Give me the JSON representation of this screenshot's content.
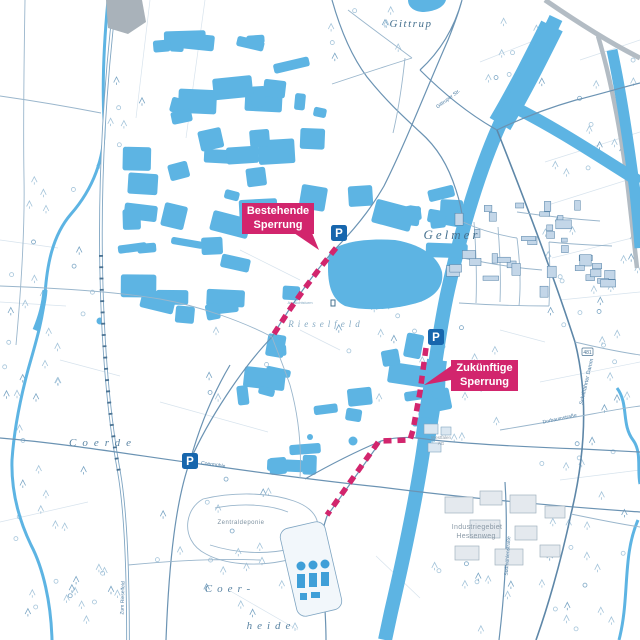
{
  "colors": {
    "accent_magenta": "#d2256d",
    "water_blue": "#5db4e3",
    "tank_blue": "#3f9fd8",
    "parking_blue": "#1766ad",
    "street_blue": "#6b93b3",
    "street_dark": "#5e87a8",
    "street_light": "#9ab6cc",
    "label_blue": "#46718f",
    "gray_road": "#b3bcc4"
  },
  "place_labels": [
    {
      "id": "gittrup",
      "text": "Gittrup",
      "x": 411,
      "y": 27,
      "size": 11,
      "spacing": 1.5,
      "italic": true,
      "color": "#46718f"
    },
    {
      "id": "gelmer",
      "text": "Gelmer",
      "x": 452,
      "y": 239,
      "size": 13,
      "spacing": 3,
      "italic": true,
      "color": "#46718f"
    },
    {
      "id": "coerde",
      "text": "Coerde",
      "x": 103,
      "y": 446,
      "size": 11,
      "spacing": 6,
      "italic": true,
      "color": "#5a84a3"
    },
    {
      "id": "rieselfeld",
      "text": "Rieselfeld",
      "x": 326,
      "y": 327,
      "size": 9,
      "spacing": 4,
      "italic": true,
      "color": "#84a9c2"
    },
    {
      "id": "zentraldeponie",
      "text": "Zentraldeponie",
      "x": 241,
      "y": 524,
      "size": 6,
      "spacing": 0.5,
      "italic": false,
      "color": "#7d91a0"
    },
    {
      "id": "coer",
      "text": "Coer-",
      "x": 230,
      "y": 592,
      "size": 11,
      "spacing": 5,
      "italic": true,
      "color": "#5a84a3"
    },
    {
      "id": "heide",
      "text": "heide",
      "x": 271,
      "y": 629,
      "size": 11,
      "spacing": 5,
      "italic": true,
      "color": "#5a84a3"
    },
    {
      "id": "industriegebiet",
      "text": "Industriegebiet",
      "x": 477,
      "y": 529,
      "size": 7,
      "spacing": 0.3,
      "italic": false,
      "color": "#8b9aa7"
    },
    {
      "id": "hessenweg-area",
      "text": "Hessenweg",
      "x": 476,
      "y": 538,
      "size": 7,
      "spacing": 0.3,
      "italic": false,
      "color": "#8b9aa7"
    },
    {
      "id": "westfalen-ag-1",
      "text": "Westfalen",
      "x": 441,
      "y": 439,
      "size": 4.5,
      "spacing": 0,
      "italic": false,
      "color": "#8b9aa7"
    },
    {
      "id": "westfalen-ag-2",
      "text": "AG",
      "x": 441,
      "y": 445,
      "size": 4.5,
      "spacing": 0,
      "italic": false,
      "color": "#8b9aa7"
    },
    {
      "id": "aussichtsturm",
      "text": "Aussichtsturm",
      "x": 300,
      "y": 304,
      "size": 4,
      "spacing": 0,
      "italic": false,
      "color": "#84a9c2"
    }
  ],
  "street_labels": [
    {
      "id": "schifffahrter-damm",
      "text": "Schifffahrter Damm",
      "x": 588,
      "y": 382,
      "size": 5.5,
      "rot": -77,
      "color": "#4d7da3"
    },
    {
      "id": "gittruper-str",
      "text": "Gittruper Str.",
      "x": 449,
      "y": 100,
      "size": 5,
      "rot": -37,
      "color": "#4d7da3"
    },
    {
      "id": "dorbaumstrasse",
      "text": "Dorbaumstraße",
      "x": 560,
      "y": 420,
      "size": 5,
      "rot": -12,
      "color": "#4d7da3"
    },
    {
      "id": "sudmuehlenstrasse",
      "text": "Sudmühlenstraße",
      "x": 509,
      "y": 556,
      "size": 5,
      "rot": -86,
      "color": "#4d7da3"
    },
    {
      "id": "zum-rieselfeld",
      "text": "Zum Rieselfeld",
      "x": 124,
      "y": 598,
      "size": 5,
      "rot": -88,
      "color": "#4d7da3"
    },
    {
      "id": "coermuehle",
      "text": "Coermühle",
      "x": 213,
      "y": 466,
      "size": 5,
      "rot": 8,
      "color": "#4d7da3"
    }
  ],
  "road_badge": {
    "text": "481",
    "x": 582,
    "y": 348
  },
  "annotations": {
    "existing_closure": {
      "line1": "Bestehende",
      "line2": "Sperrung",
      "box": {
        "x": 242,
        "y": 203,
        "w": 72,
        "h": 31
      },
      "pointer": [
        [
          294,
          233
        ],
        [
          312,
          233
        ],
        [
          319,
          250
        ]
      ],
      "route": [
        [
          336,
          248
        ],
        [
          320,
          268
        ],
        [
          305,
          288
        ],
        [
          288,
          312
        ],
        [
          272,
          337
        ]
      ]
    },
    "future_closure": {
      "line1": "Zukünftige",
      "line2": "Sperrung",
      "box": {
        "x": 451,
        "y": 360,
        "w": 67,
        "h": 31
      },
      "pointer": [
        [
          451,
          366
        ],
        [
          451,
          380
        ],
        [
          424,
          385
        ]
      ],
      "route": [
        [
          426,
          348
        ],
        [
          420,
          392
        ],
        [
          413,
          430
        ],
        [
          410,
          440
        ],
        [
          379,
          441
        ],
        [
          327,
          515
        ]
      ]
    },
    "route_style": {
      "stroke_width": 5.5,
      "dash": "8 6"
    }
  },
  "parking_markers": [
    {
      "x": 339,
      "y": 233,
      "label": "P"
    },
    {
      "x": 436,
      "y": 337,
      "label": "P"
    },
    {
      "x": 190,
      "y": 461,
      "label": "P"
    }
  ]
}
